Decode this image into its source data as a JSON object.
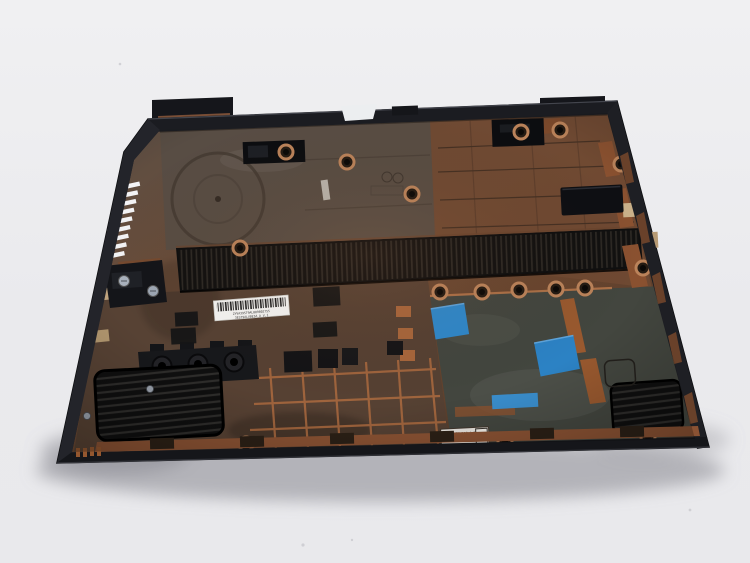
{
  "scene": {
    "type": "product-photo",
    "subject": "laptop bottom case, inner side, black plastic with copper coating",
    "background": "#ecedef"
  },
  "stickers": {
    "barcode": {
      "line1": "ZYVA39ST9AL00980275S",
      "line2": "3EST9ALV0E3A A   V.1"
    },
    "stamp": {
      "line1": "P/N 5175W150 A/2P",
      "line2": "2015.11.03 19:42",
      "digit": "3"
    }
  },
  "palette": {
    "background": "#ecedef",
    "case_rim": "#1d1e23",
    "interior_brown": "#5d483a",
    "copper": "#9c5f3a",
    "bay_gray": "#43463f",
    "vent_black": "#121212",
    "tape_blue": "#2f87c9",
    "label_white": "#f6f6f4"
  }
}
